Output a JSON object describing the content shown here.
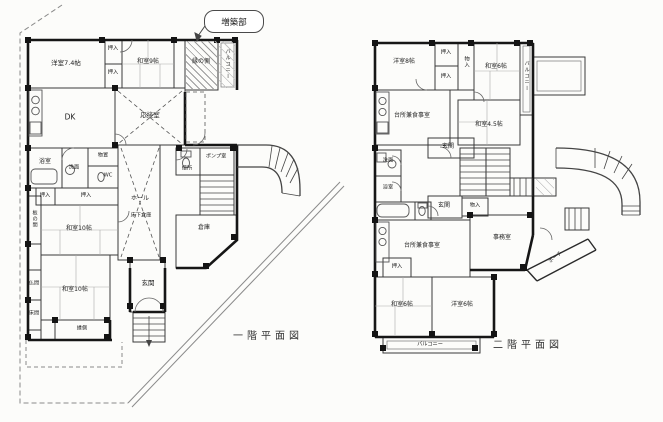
{
  "colors": {
    "paper": "#fcfcfa",
    "ink": "#2b2b2b",
    "wall": "#161616",
    "hatch": "#9a9a9a"
  },
  "callout": {
    "label": "増築部"
  },
  "floor1": {
    "caption": "一階平面図",
    "rooms": {
      "yoshitsu74": "洋室7.4帖",
      "oshiire_a": "押入",
      "oshiire_b": "押入",
      "washitsu9": "和室9帖",
      "ennogawa": "縁の側",
      "balcony": "バルコニー",
      "dk": "DK",
      "ousetsu": "応接室",
      "yokushitsu": "浴室",
      "senmen": "洗面",
      "monooki": "物置",
      "wc": "WC",
      "oshiire_c": "押入",
      "oshiire_d": "押入",
      "itanoma": "板の間",
      "hall": "ホール",
      "yukashita_souko": "床下倉庫",
      "washitsu10a": "和室10帖",
      "butsuma": "仏間",
      "tokonoma": "床間",
      "washitsu10b": "和室10帖",
      "engawa": "縁側",
      "genkan": "玄関",
      "benjo": "便所",
      "pump": "ポンプ室",
      "souko": "倉庫"
    }
  },
  "floor2": {
    "caption": "二階平面図",
    "rooms": {
      "yoshitsu8": "洋室8帖",
      "oshiire_a": "押入",
      "oshiire_b": "押入",
      "monoire_a": "物入",
      "washitsu6a": "和室6帖",
      "balcony_right": "バルコニー",
      "daidokoro_upper": "台所兼食事室",
      "washitsu45": "和室4.5帖",
      "genkan_upper": "玄関",
      "senmen": "洗面",
      "yokushitsu": "浴室",
      "genkan_lower": "玄関",
      "monoire_b": "物入",
      "daidokoro_lower": "台所兼食事室",
      "jimushitsu": "事務室",
      "oshiire_c": "押入",
      "washitsu6b": "和室6帖",
      "yoshitsu6": "洋室6帖",
      "balcony_bottom": "バルコニー",
      "porch": "ポーチ"
    }
  }
}
